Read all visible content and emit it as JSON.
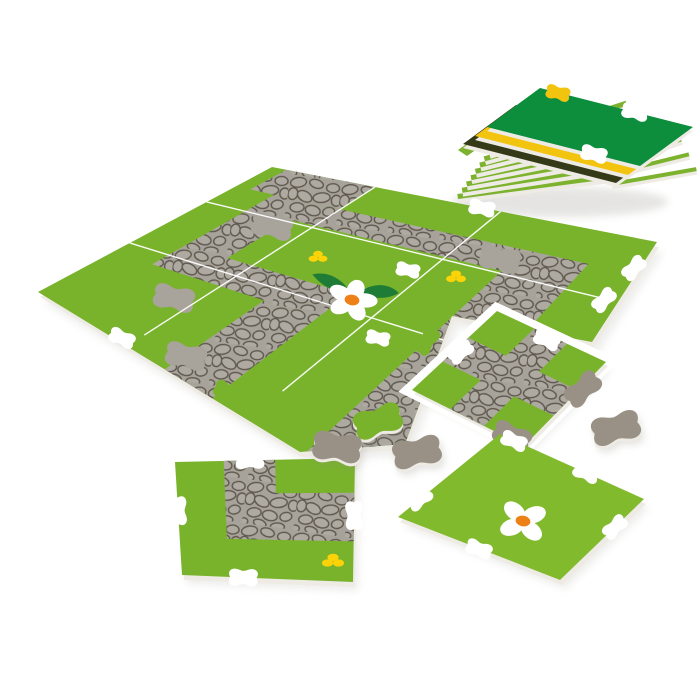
{
  "scene": {
    "description": "Product photo: partially assembled foam jigsaw play mat of green tiles with gray cobblestone paths, a white daisy, small yellow flowers, loose path tiles and connector pieces, and a fanned stack of spare tiles",
    "background": "#ffffff"
  },
  "colors": {
    "grass": "#79b32c",
    "grass_bright": "#82ba2e",
    "fan_green": "#7db22f",
    "path_gray": "#a7a39b",
    "stone_fill": "#aeaaa2",
    "stone_outline": "#5e574c",
    "connector_gray": "#9a9186",
    "patch_gray": "#a8a39b",
    "forest_green": "#0d8e3d",
    "stack_yellow": "#f3c40f",
    "stack_olive": "#343a18",
    "daisy_white": "#ffffff",
    "daisy_center": "#ee8018",
    "leaf_green": "#1e7c37",
    "accent_yellow": "#fbd308",
    "foam_edge": "#edebe4",
    "halo_white": "#ffffff",
    "shadow": "#8b897f"
  },
  "objects": {
    "tile_stack": {
      "name": "spare-tile-stack",
      "layers": [
        "light-green",
        "light-green",
        "light-green",
        "light-green",
        "light-green",
        "light-green",
        "light-green",
        "light-green",
        "light-green",
        "dark-olive",
        "yellow",
        "forest-green"
      ]
    },
    "assembled_mat": {
      "name": "assembled-play-mat",
      "grid": "3x3",
      "features": [
        "cobblestone-path",
        "white-daisy",
        "yellow-flowers",
        "gray-connector-patches",
        "tile-seams"
      ]
    },
    "cross_tile": {
      "name": "cross-path-tile",
      "feature": "cobblestone-crossroads"
    },
    "corner_tile": {
      "name": "corner-path-tile",
      "features": [
        "cobblestone-corner",
        "yellow-flower"
      ]
    },
    "daisy_tile": {
      "name": "daisy-tile",
      "feature": "white-daisy"
    },
    "loose_connectors": {
      "name": "loose-connector-pieces",
      "count": 4,
      "colors": [
        "green",
        "gray",
        "gray",
        "gray"
      ]
    }
  }
}
